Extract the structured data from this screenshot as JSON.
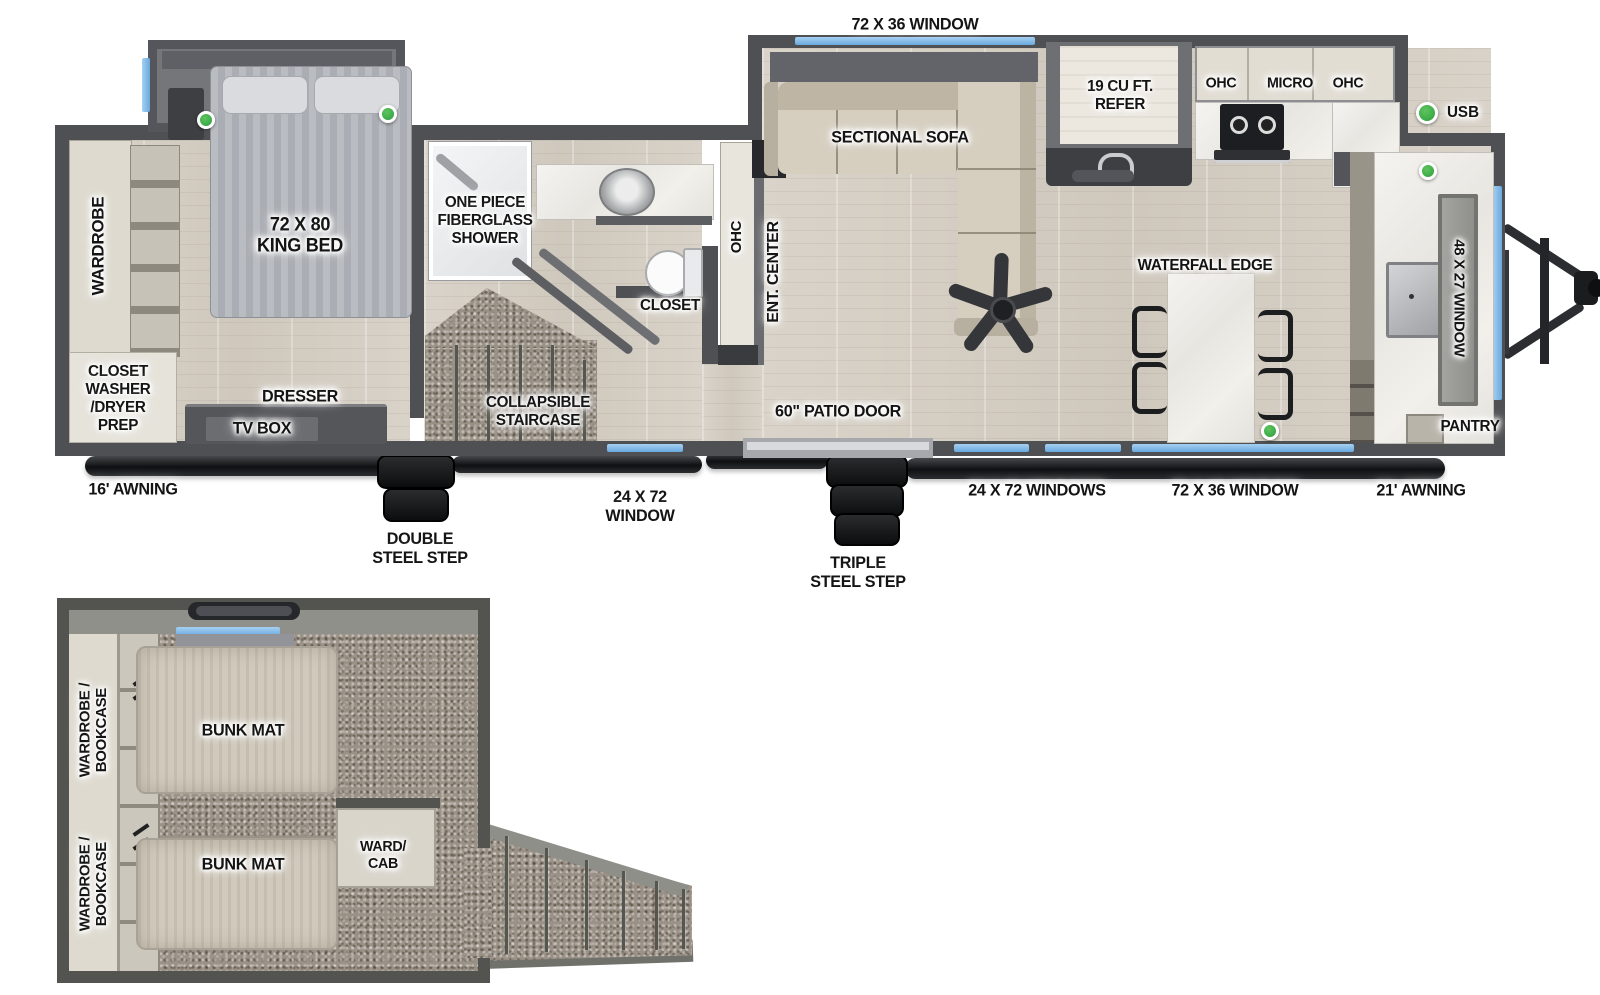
{
  "colors": {
    "wall": "#4f5053",
    "window_blue": "#79b4e6",
    "usb_green": "#3fae49",
    "wood_floor": "#d5cfc5",
    "carpet": "#9b9287",
    "counter_marble": "#efede8",
    "cabinet_light": "#dedacf",
    "sofa_beige": "#d6cfc0",
    "label_text": "#141414"
  },
  "main": {
    "top": {
      "window_72x36": "72 X 36 WINDOW"
    },
    "legend": {
      "usb": "USB"
    },
    "bedroom": {
      "wardrobe": "WARDROBE",
      "closet_washer_dryer": "CLOSET\nWASHER\n/DRYER\nPREP",
      "king_bed": "72 X 80\nKING BED",
      "dresser": "DRESSER",
      "tv_box": "TV BOX"
    },
    "bath": {
      "shower": "ONE PIECE\nFIBERGLASS\nSHOWER",
      "closet": "CLOSET",
      "ohc": "OHC"
    },
    "living": {
      "ent_center": "ENT. CENTER",
      "sectional_sofa": "SECTIONAL SOFA",
      "collapsible_staircase": "COLLAPSIBLE\nSTAIRCASE",
      "patio_door": "60\" PATIO DOOR"
    },
    "kitchen": {
      "refer": "19 CU FT.\nREFER",
      "ohc_left": "OHC",
      "micro": "MICRO",
      "ohc_right": "OHC",
      "waterfall_edge": "WATERFALL EDGE",
      "window_48x27": "48 X 27 WINDOW",
      "pantry": "PANTRY"
    },
    "bottom": {
      "awning_16": "16' AWNING",
      "double_step": "DOUBLE\nSTEEL STEP",
      "window_24x72": "24 X 72\nWINDOW",
      "triple_step": "TRIPLE\nSTEEL STEP",
      "windows_24x72": "24 X 72 WINDOWS",
      "window_72x36": "72 X 36 WINDOW",
      "awning_21": "21' AWNING"
    }
  },
  "loft": {
    "wardrobe_bookcase_1": "WARDROBE /\nBOOKCASE",
    "wardrobe_bookcase_2": "WARDROBE /\nBOOKCASE",
    "bunk_mat_1": "BUNK MAT",
    "bunk_mat_2": "BUNK MAT",
    "ward_cab": "WARD/\nCAB"
  }
}
